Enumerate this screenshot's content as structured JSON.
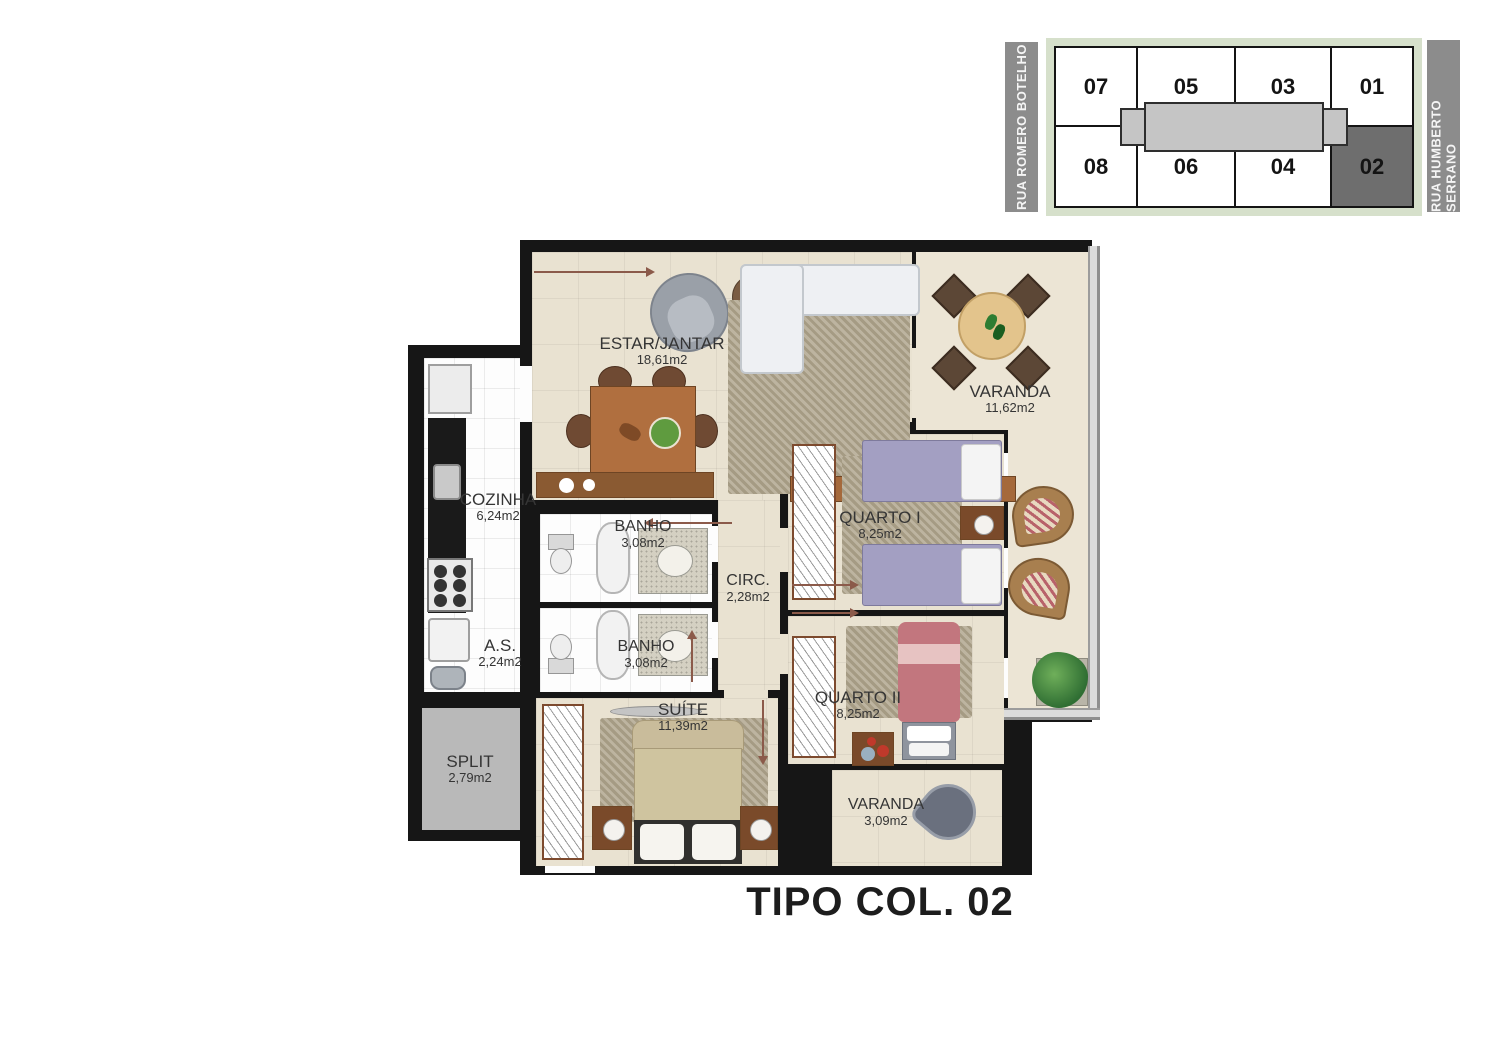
{
  "title": "TIPO COL. 02",
  "key_plan": {
    "street_left": "RUA ROMERO BOTELHO",
    "street_right": "RUA HUMBERTO SERRANO",
    "units_top": [
      "07",
      "05",
      "03",
      "01"
    ],
    "units_bottom": [
      "08",
      "06",
      "04",
      "02"
    ],
    "highlighted_unit": "02",
    "colors": {
      "street_bar": "#8c8c8c",
      "building_outline_band": "#d6e0cb",
      "corridor": "#c5c5c5",
      "highlighted_unit_bg": "#6e6e6e"
    }
  },
  "rooms": {
    "estar": {
      "name": "ESTAR/JANTAR",
      "area": "18,61m2"
    },
    "varanda": {
      "name": "VARANDA",
      "area": "11,62m2"
    },
    "cozinha": {
      "name": "COZINHA",
      "area": "6,24m2"
    },
    "as": {
      "name": "A.S.",
      "area": "2,24m2"
    },
    "banho1": {
      "name": "BANHO",
      "area": "3,08m2"
    },
    "banho2": {
      "name": "BANHO",
      "area": "3,08m2"
    },
    "circ": {
      "name": "CIRC.",
      "area": "2,28m2"
    },
    "quarto1": {
      "name": "QUARTO I",
      "area": "8,25m2"
    },
    "quarto2": {
      "name": "QUARTO II",
      "area": "8,25m2"
    },
    "suite": {
      "name": "SUÍTE",
      "area": "11,39m2"
    },
    "split": {
      "name": "SPLIT",
      "area": "2,79m2"
    },
    "varanda2": {
      "name": "VARANDA",
      "area": "3,09m2"
    }
  },
  "plan_colors": {
    "wall": "#161616",
    "floor": "#e9e2d1",
    "wet_floor": "#fdfdfd",
    "split_floor": "#b9b9b9"
  }
}
